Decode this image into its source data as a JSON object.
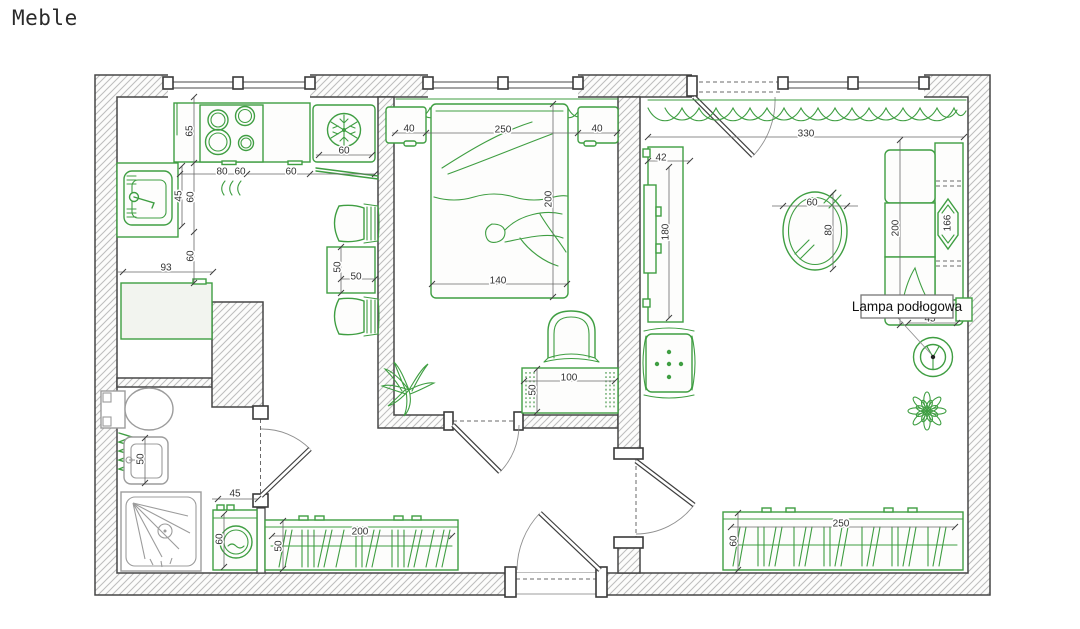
{
  "title": "Meble",
  "floor_lamp_label": "Lampa podłogowa",
  "colors": {
    "furniture_green": "#3f9e42",
    "wall_outline": "#474747",
    "hatch_gray": "#bdbdbd",
    "fixture_gray": "#9c9c9c",
    "dimension_text": "#333333"
  },
  "dims": {
    "k_counter_depth": "65",
    "k_stove_w": "80",
    "k_seg1": "60",
    "k_seg2": "60",
    "k_fridge": "60",
    "k_sink_depth": "45",
    "k_left1": "60",
    "k_left2": "60",
    "k_cab_w": "93",
    "k_table_w": "50",
    "k_table_d": "50",
    "b_ns_l": "40",
    "b_window": "250",
    "b_ns_r": "40",
    "b_bed_l": "200",
    "b_bed_w": "140",
    "b_bench_w": "100",
    "b_bench_d": "50",
    "l_width": "330",
    "l_tv_d": "42",
    "l_tv_w": "180",
    "l_tbl_w": "60",
    "l_tbl_l": "80",
    "l_sofa_l": "200",
    "l_sofa_inner": "166",
    "l_lamp_off": "45",
    "l_ward_w": "250",
    "l_ward_d": "60",
    "ba_sink": "50",
    "ba_door": "45",
    "ba_washer": "60",
    "h_ward_w": "200",
    "h_ward_d": "50"
  }
}
